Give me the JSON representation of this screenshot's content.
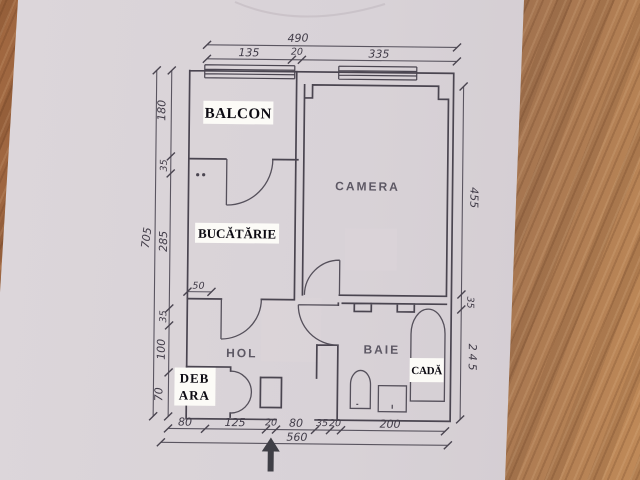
{
  "rooms": {
    "balcon": "BALCON",
    "bucatarie": "BUCĂTĂRIE",
    "camera": "CAMERA",
    "hol": "HOL",
    "baie": "BAIE",
    "cada": "CADĂ",
    "debara_line1": "DEB",
    "debara_line2": "ARA"
  },
  "dims": {
    "top_total": "490",
    "top": [
      "135",
      "20",
      "335"
    ],
    "left": [
      "180",
      "35",
      "285",
      "35",
      "100",
      "70"
    ],
    "left_total": "705",
    "right": [
      "455",
      "35",
      "245"
    ],
    "bottom": [
      "80",
      "125",
      "20",
      "80",
      "35",
      "20",
      "200"
    ],
    "bottom_total": "560",
    "kitchen": "50"
  },
  "colors": {
    "paper": "#d9d3d8",
    "wood": "#9b6a4a",
    "ink": "#4a4550",
    "label_bg": "#fcfbf7"
  }
}
